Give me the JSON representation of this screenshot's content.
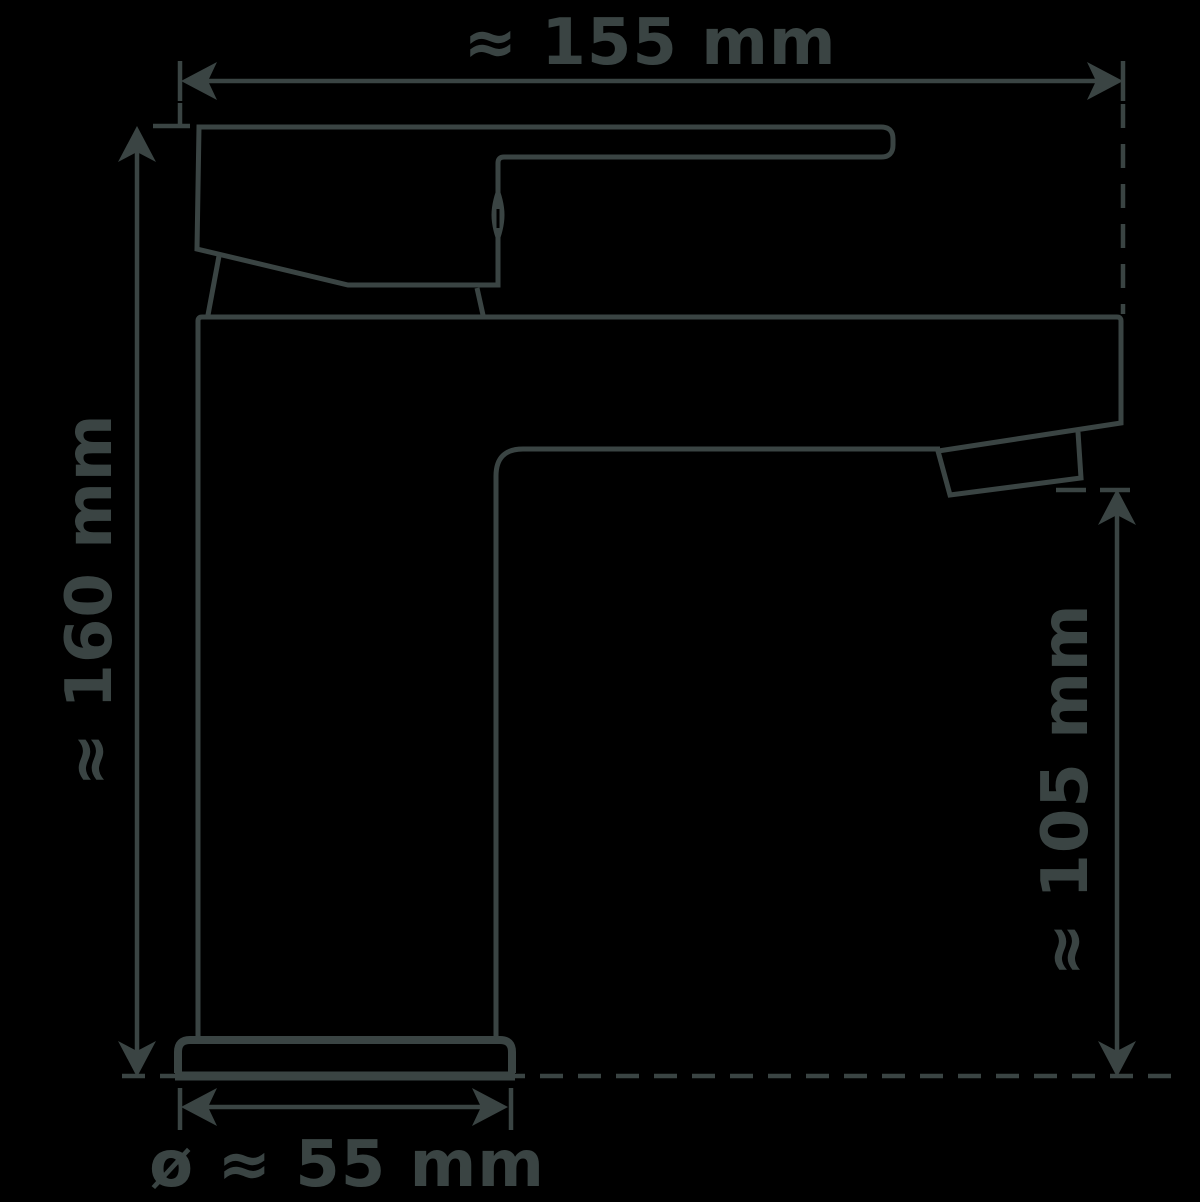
{
  "diagram": {
    "background_color": "#000000",
    "line_color": "#3a4443",
    "labels": {
      "width": "≈ 155 mm",
      "height": "≈ 160 mm",
      "spout_height": "≈ 105 mm",
      "base_diameter": "ø ≈ 55 mm"
    }
  }
}
